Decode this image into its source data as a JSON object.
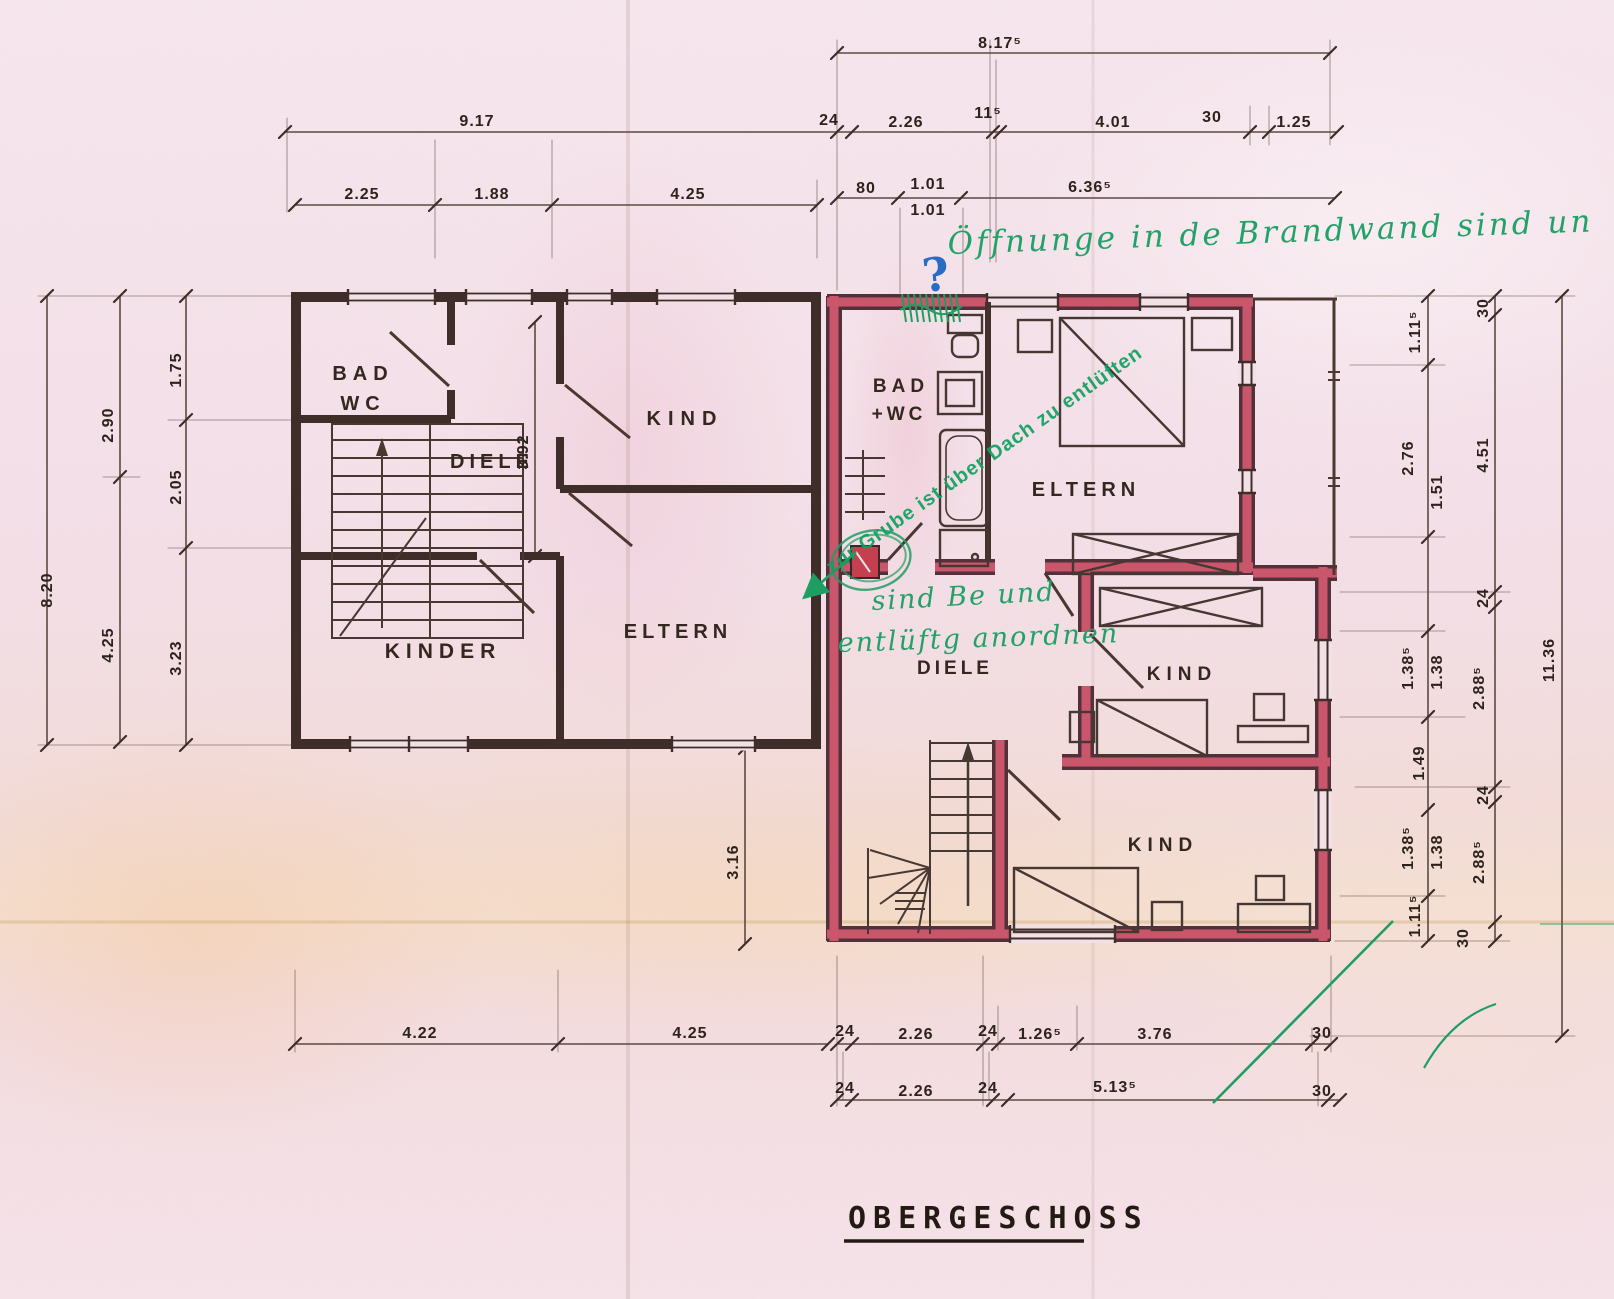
{
  "title": {
    "label": "OBERGESCHOSS"
  },
  "colors": {
    "paper": "#f2e0e7",
    "pencil": "#3e2d28",
    "wall_red": "#c9566a",
    "annotation_green": "#1f9e63",
    "annotation_blue": "#2a6bc5",
    "dim_line": "#5d4a42"
  },
  "left_building": {
    "rooms": [
      "BAD WC",
      "DIELE",
      "KIND",
      "KINDER",
      "ELTERN"
    ]
  },
  "right_building": {
    "rooms": [
      "BAD +WC",
      "ELTERN",
      "DIELE",
      "KIND",
      "KIND"
    ]
  },
  "annotations": {
    "top_note": "Öffnunge in de Brandwand sind un",
    "roof_vent_stamp": "zur Grube ist über Dach zu entlüften",
    "vent_note_line1": "sind Be und",
    "vent_note_line2": "entlüftg anordnen",
    "question_mark": "?"
  },
  "room_labels": [
    {
      "t": "BAD",
      "x": 363,
      "y": 380,
      "fs": 20,
      "ls": 6,
      "b": "left"
    },
    {
      "t": "WC",
      "x": 363,
      "y": 410,
      "fs": 20,
      "ls": 6,
      "b": "left"
    },
    {
      "t": "DIELE",
      "x": 492,
      "y": 468,
      "fs": 20,
      "ls": 5,
      "b": "left"
    },
    {
      "t": "KIND",
      "x": 685,
      "y": 425,
      "fs": 20,
      "ls": 7,
      "b": "left"
    },
    {
      "t": "KINDER",
      "x": 443,
      "y": 658,
      "fs": 21,
      "ls": 6,
      "b": "left"
    },
    {
      "t": "ELTERN",
      "x": 678,
      "y": 638,
      "fs": 20,
      "ls": 5,
      "b": "left"
    },
    {
      "t": "BAD",
      "x": 901,
      "y": 392,
      "fs": 19,
      "ls": 5,
      "b": "right"
    },
    {
      "t": "+WC",
      "x": 899,
      "y": 420,
      "fs": 19,
      "ls": 4,
      "b": "right"
    },
    {
      "t": "ELTERN",
      "x": 1086,
      "y": 496,
      "fs": 20,
      "ls": 5,
      "b": "right"
    },
    {
      "t": "DIELE",
      "x": 955,
      "y": 674,
      "fs": 19,
      "ls": 4,
      "b": "right"
    },
    {
      "t": "KIND",
      "x": 1182,
      "y": 680,
      "fs": 19,
      "ls": 6,
      "b": "right"
    },
    {
      "t": "KIND",
      "x": 1163,
      "y": 851,
      "fs": 19,
      "ls": 6,
      "b": "right"
    }
  ],
  "dim_labels": [
    {
      "t": "8.17⁵",
      "x": 1000,
      "y": 48,
      "r": 0,
      "grp": "top"
    },
    {
      "t": "9.17",
      "x": 477,
      "y": 126,
      "r": 0,
      "grp": "top"
    },
    {
      "t": "24",
      "x": 829,
      "y": 125,
      "r": 0,
      "grp": "top"
    },
    {
      "t": "2.26",
      "x": 906,
      "y": 127,
      "r": 0,
      "grp": "top"
    },
    {
      "t": "11⁵",
      "x": 988,
      "y": 118,
      "r": 0,
      "grp": "top"
    },
    {
      "t": "4.01",
      "x": 1113,
      "y": 127,
      "r": 0,
      "grp": "top"
    },
    {
      "t": "30",
      "x": 1212,
      "y": 122,
      "r": 0,
      "grp": "top"
    },
    {
      "t": "1.25",
      "x": 1294,
      "y": 127,
      "r": 0,
      "grp": "top"
    },
    {
      "t": "2.25",
      "x": 362,
      "y": 199,
      "r": 0,
      "grp": "top"
    },
    {
      "t": "1.88",
      "x": 492,
      "y": 199,
      "r": 0,
      "grp": "top"
    },
    {
      "t": "4.25",
      "x": 688,
      "y": 199,
      "r": 0,
      "grp": "top"
    },
    {
      "t": "80",
      "x": 866,
      "y": 193,
      "r": 0,
      "grp": "top"
    },
    {
      "t": "1.01",
      "x": 928,
      "y": 189,
      "r": 0,
      "grp": "top"
    },
    {
      "t": "1.01",
      "x": 928,
      "y": 215,
      "r": 0,
      "grp": "top"
    },
    {
      "t": "6.36⁵",
      "x": 1090,
      "y": 192,
      "r": 0,
      "grp": "top"
    },
    {
      "t": "8.20",
      "x": 52,
      "y": 590,
      "r": -90,
      "grp": "left"
    },
    {
      "t": "2.90",
      "x": 113,
      "y": 425,
      "r": -90,
      "grp": "left"
    },
    {
      "t": "4.25",
      "x": 113,
      "y": 645,
      "r": -90,
      "grp": "left"
    },
    {
      "t": "1.75",
      "x": 181,
      "y": 370,
      "r": -90,
      "grp": "left"
    },
    {
      "t": "2.05",
      "x": 181,
      "y": 487,
      "r": -90,
      "grp": "left"
    },
    {
      "t": "3.23",
      "x": 181,
      "y": 658,
      "r": -90,
      "grp": "left"
    },
    {
      "t": "3.92",
      "x": 528,
      "y": 452,
      "r": -90,
      "grp": "interior"
    },
    {
      "t": "3.16",
      "x": 738,
      "y": 862,
      "r": -90,
      "grp": "interior"
    },
    {
      "t": "1.11⁵",
      "x": 1420,
      "y": 332,
      "r": -90,
      "grp": "right"
    },
    {
      "t": "2.76",
      "x": 1413,
      "y": 458,
      "r": -90,
      "grp": "right"
    },
    {
      "t": "1.51",
      "x": 1442,
      "y": 492,
      "r": -90,
      "grp": "right"
    },
    {
      "t": "1.38⁵",
      "x": 1413,
      "y": 668,
      "r": -90,
      "grp": "right"
    },
    {
      "t": "1.38",
      "x": 1442,
      "y": 672,
      "r": -90,
      "grp": "right"
    },
    {
      "t": "1.49",
      "x": 1424,
      "y": 763,
      "r": -90,
      "grp": "right"
    },
    {
      "t": "1.38⁵",
      "x": 1413,
      "y": 848,
      "r": -90,
      "grp": "right"
    },
    {
      "t": "1.38",
      "x": 1442,
      "y": 852,
      "r": -90,
      "grp": "right"
    },
    {
      "t": "1.11⁵",
      "x": 1420,
      "y": 916,
      "r": -90,
      "grp": "right"
    },
    {
      "t": "30",
      "x": 1488,
      "y": 308,
      "r": -90,
      "grp": "right"
    },
    {
      "t": "4.51",
      "x": 1488,
      "y": 455,
      "r": -90,
      "grp": "right"
    },
    {
      "t": "24",
      "x": 1488,
      "y": 598,
      "r": -90,
      "grp": "right"
    },
    {
      "t": "2.88⁵",
      "x": 1484,
      "y": 688,
      "r": -90,
      "grp": "right"
    },
    {
      "t": "24",
      "x": 1488,
      "y": 795,
      "r": -90,
      "grp": "right"
    },
    {
      "t": "2.88⁵",
      "x": 1484,
      "y": 862,
      "r": -90,
      "grp": "right"
    },
    {
      "t": "30",
      "x": 1468,
      "y": 938,
      "r": -90,
      "grp": "right"
    },
    {
      "t": "11.36",
      "x": 1554,
      "y": 660,
      "r": -90,
      "grp": "right"
    },
    {
      "t": "4.22",
      "x": 420,
      "y": 1038,
      "r": 0,
      "grp": "bottom"
    },
    {
      "t": "4.25",
      "x": 690,
      "y": 1038,
      "r": 0,
      "grp": "bottom"
    },
    {
      "t": "24",
      "x": 845,
      "y": 1036,
      "r": 0,
      "grp": "bottom"
    },
    {
      "t": "2.26",
      "x": 916,
      "y": 1039,
      "r": 0,
      "grp": "bottom"
    },
    {
      "t": "24",
      "x": 988,
      "y": 1036,
      "r": 0,
      "grp": "bottom"
    },
    {
      "t": "1.26⁵",
      "x": 1040,
      "y": 1039,
      "r": 0,
      "grp": "bottom"
    },
    {
      "t": "3.76",
      "x": 1155,
      "y": 1039,
      "r": 0,
      "grp": "bottom"
    },
    {
      "t": "30",
      "x": 1322,
      "y": 1038,
      "r": 0,
      "grp": "bottom"
    },
    {
      "t": "24",
      "x": 845,
      "y": 1093,
      "r": 0,
      "grp": "bottom"
    },
    {
      "t": "2.26",
      "x": 916,
      "y": 1096,
      "r": 0,
      "grp": "bottom"
    },
    {
      "t": "24",
      "x": 988,
      "y": 1093,
      "r": 0,
      "grp": "bottom"
    },
    {
      "t": "5.13⁵",
      "x": 1115,
      "y": 1092,
      "r": 0,
      "grp": "bottom"
    },
    {
      "t": "30",
      "x": 1322,
      "y": 1096,
      "r": 0,
      "grp": "bottom"
    }
  ]
}
